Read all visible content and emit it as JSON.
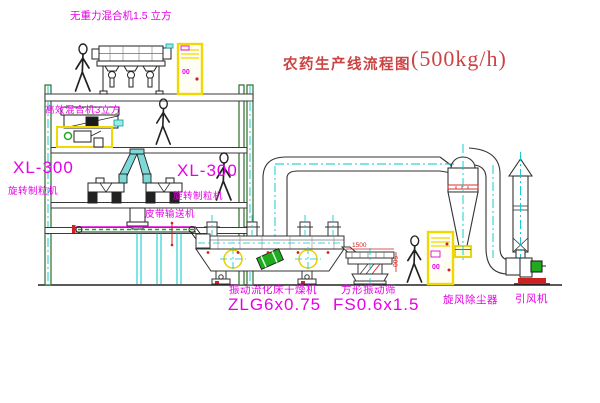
{
  "title": {
    "text": "农药生产线流程图",
    "capacity": "(500kg/h)"
  },
  "labels": {
    "gravity_free_mixer": "无重力混合机1.5 立方",
    "high_efficiency_mixer": "高效混合机3立方",
    "granulator_left_model": "XL-300",
    "granulator_left_name": "旋转制粒机",
    "granulator_right_model": "XL-300",
    "granulator_right_name": "旋转制粒机",
    "belt_conveyor": "皮带输送机",
    "fluid_bed_dryer_name": "振动流化床干燥机",
    "fluid_bed_dryer_model": "ZLG6x0.75",
    "vibrating_screen_name": "方形振动筛",
    "vibrating_screen_model": "FS0.6x1.5",
    "cyclone_dust_collector": "旋风除尘器",
    "induced_draft_fan": "引风机"
  },
  "dimensions": {
    "screen_length": "1500",
    "screen_height": "500"
  },
  "control_panel_marking": "00",
  "colors": {
    "label_magenta": "#e600e6",
    "title_red": "#cb4343",
    "structure_green": "#2d6b2d",
    "centerline_cyan": "#00c8c8",
    "cad_yellow": "#f0d800",
    "accent_red": "#cc2222",
    "accent_green": "#1faa1f"
  }
}
